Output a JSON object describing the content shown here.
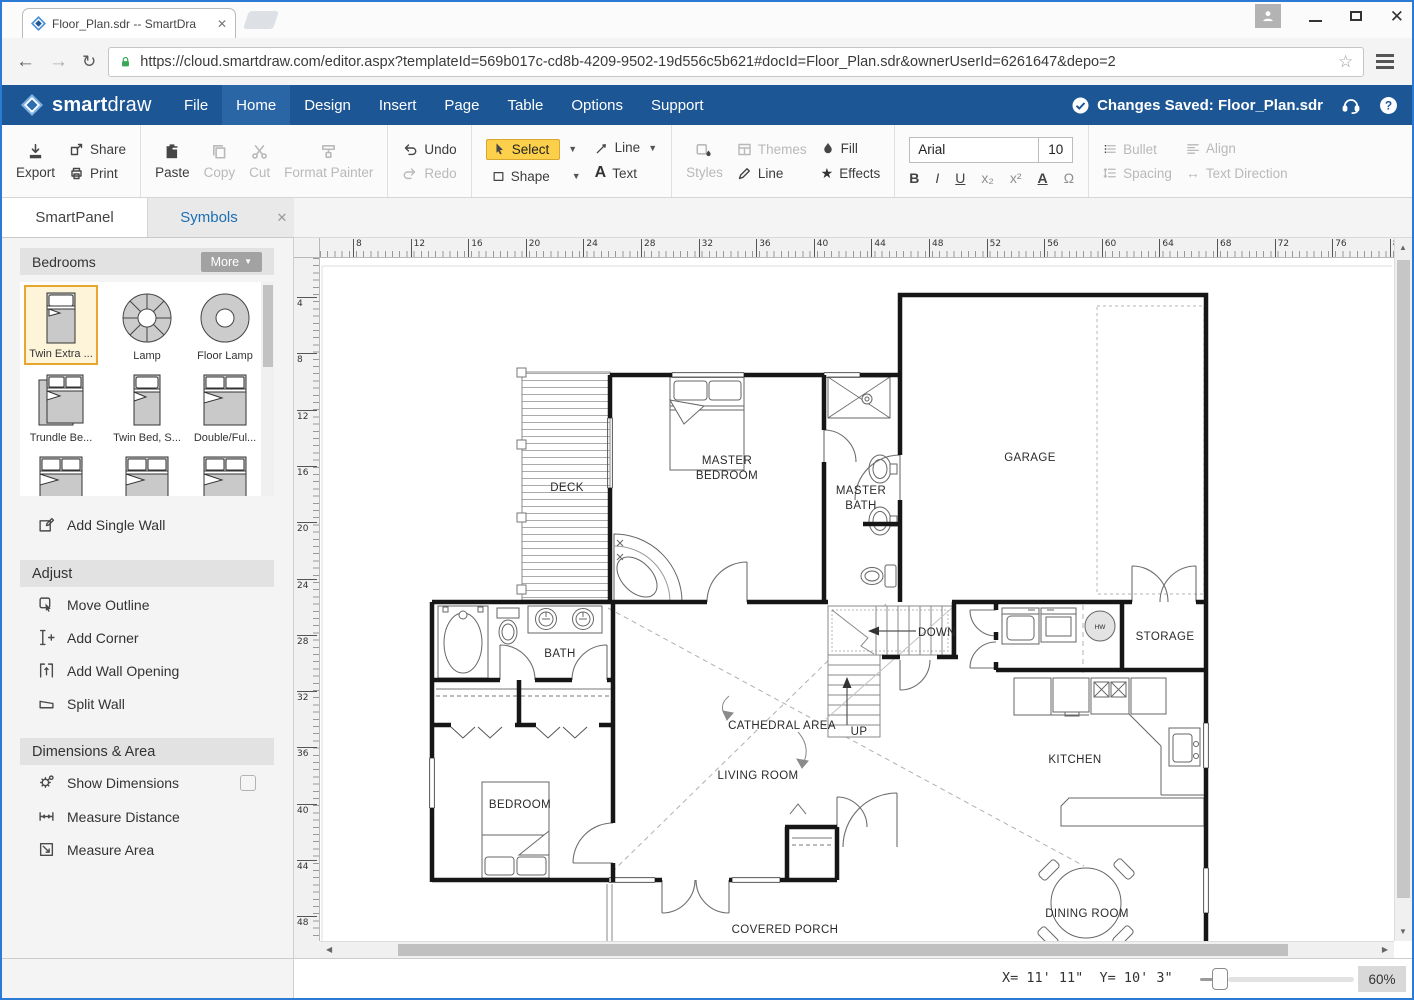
{
  "browser": {
    "tab_title": "Floor_Plan.sdr -- SmartDra",
    "url": "https://cloud.smartdraw.com/editor.aspx?templateId=569b017c-cd8b-4209-9502-19d556c5b621#docId=Floor_Plan.sdr&ownerUserId=6261647&depo=2"
  },
  "menubar": {
    "brand_bold": "smart",
    "brand_light": "draw",
    "items": [
      {
        "label": "File"
      },
      {
        "label": "Home"
      },
      {
        "label": "Design"
      },
      {
        "label": "Insert"
      },
      {
        "label": "Page"
      },
      {
        "label": "Table"
      },
      {
        "label": "Options"
      },
      {
        "label": "Support"
      }
    ],
    "saved_status": "Changes Saved: Floor_Plan.sdr"
  },
  "toolbar": {
    "export": "Export",
    "share": "Share",
    "print": "Print",
    "paste": "Paste",
    "copy": "Copy",
    "cut": "Cut",
    "format_painter": "Format Painter",
    "undo": "Undo",
    "redo": "Redo",
    "select": "Select",
    "shape": "Shape",
    "line_tool": "Line",
    "text_tool": "Text",
    "styles": "Styles",
    "themes": "Themes",
    "line_style": "Line",
    "fill": "Fill",
    "effects": "Effects",
    "font_name": "Arial",
    "font_size": "10",
    "bold": "B",
    "italic": "I",
    "underline": "U",
    "subscript": "x₂",
    "superscript": "x²",
    "font_color": "A",
    "symbol": "Ω",
    "bullet": "Bullet",
    "align": "Align",
    "spacing": "Spacing",
    "text_direction": "Text Direction"
  },
  "panel": {
    "tab_smartpanel": "SmartPanel",
    "tab_symbols": "Symbols",
    "close": "✕",
    "category": "Bedrooms",
    "more": "More",
    "symbols": [
      {
        "label": "Twin Extra ..."
      },
      {
        "label": "Lamp"
      },
      {
        "label": "Floor Lamp"
      },
      {
        "label": "Trundle Be..."
      },
      {
        "label": "Twin Bed, S..."
      },
      {
        "label": "Double/Ful..."
      },
      {
        "label": ""
      },
      {
        "label": ""
      },
      {
        "label": ""
      }
    ],
    "add_single_wall": "Add Single Wall",
    "adjust_title": "Adjust",
    "adjust_items": [
      "Move Outline",
      "Add Corner",
      "Add Wall Opening",
      "Split Wall"
    ],
    "dimensions_title": "Dimensions & Area",
    "dimensions_items": [
      "Show Dimensions",
      "Measure Distance",
      "Measure Area"
    ]
  },
  "canvas": {
    "rulers": {
      "top": {
        "first": 8,
        "last": 80,
        "step": 4,
        "origin": 33,
        "spacing": 57.6
      },
      "left": {
        "first": 4,
        "last": 48,
        "step": 4,
        "origin": 39,
        "spacing": 56.3
      }
    }
  },
  "floor_plan": {
    "labels": [
      {
        "text": "DECK",
        "x": 247,
        "y": 233
      },
      {
        "text": "MASTER",
        "x": 407,
        "y": 206
      },
      {
        "text": "BEDROOM",
        "x": 407,
        "y": 221
      },
      {
        "text": "MASTER",
        "x": 541,
        "y": 236
      },
      {
        "text": "BATH",
        "x": 541,
        "y": 251
      },
      {
        "text": "GARAGE",
        "x": 710,
        "y": 203
      },
      {
        "text": "BATH",
        "x": 240,
        "y": 399
      },
      {
        "text": "DOWN",
        "x": 617,
        "y": 378
      },
      {
        "text": "STORAGE",
        "x": 845,
        "y": 382
      },
      {
        "text": "CATHEDRAL AREA",
        "x": 462,
        "y": 471
      },
      {
        "text": "UP",
        "x": 539,
        "y": 477
      },
      {
        "text": "LIVING ROOM",
        "x": 438,
        "y": 521
      },
      {
        "text": "KITCHEN",
        "x": 755,
        "y": 505
      },
      {
        "text": "BEDROOM",
        "x": 200,
        "y": 550
      },
      {
        "text": "COVERED PORCH",
        "x": 465,
        "y": 675
      },
      {
        "text": "DINING ROOM",
        "x": 767,
        "y": 659
      }
    ],
    "hw_label": "HW"
  },
  "statusbar": {
    "coords": "X= 11' 11\"  Y= 10' 3\"",
    "zoom": "60%"
  },
  "colors": {
    "menubar_blue": "#1d5694",
    "active_menu": "#2a66a6",
    "select_highlight": "#fcd04b",
    "symbols_tab_blue": "#1a6fb5",
    "window_border": "#2b7bd4"
  }
}
